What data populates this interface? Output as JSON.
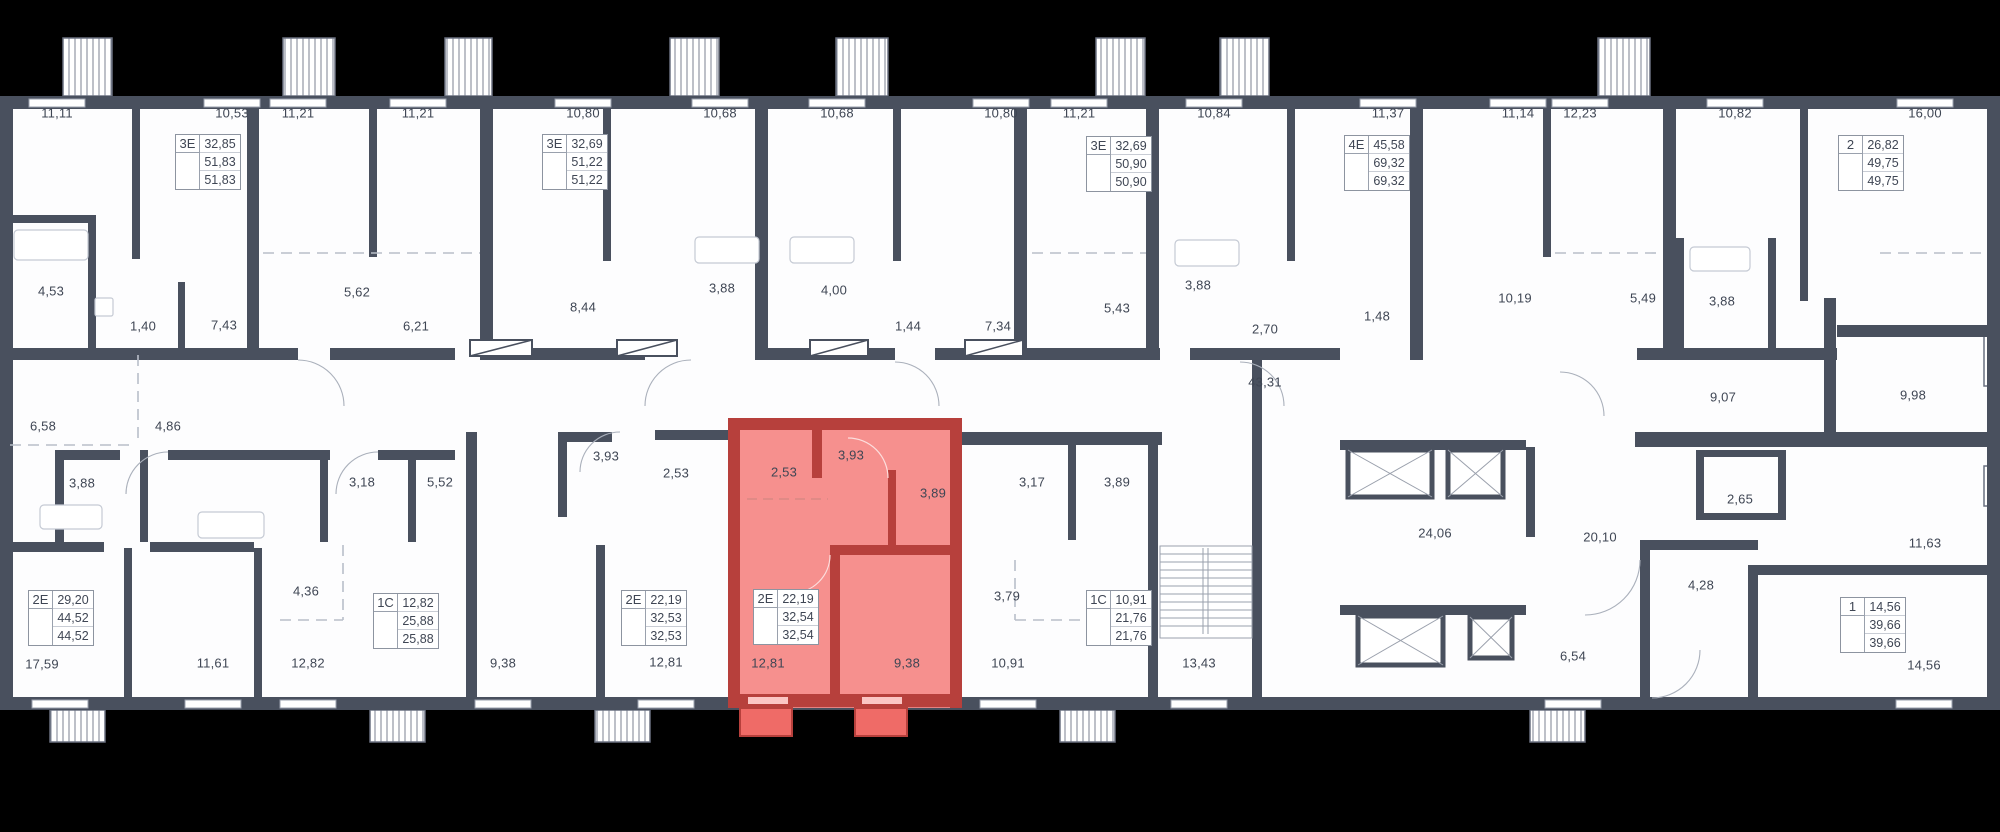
{
  "colors": {
    "wall": "#49505e",
    "background": "#000000",
    "highlight_fill": "#f58784",
    "highlight_wall": "#b7403c"
  },
  "rooms": [
    "11,11",
    "10,53",
    "11,21",
    "11,21",
    "10,80",
    "10,68",
    "10,68",
    "10,80",
    "11,21",
    "10,84",
    "11,37",
    "11,14",
    "12,23",
    "10,82",
    "16,00",
    "4,53",
    "1,40",
    "7,43",
    "5,62",
    "6,21",
    "8,44",
    "3,88",
    "4,00",
    "1,44",
    "7,34",
    "5,43",
    "3,88",
    "2,70",
    "1,48",
    "10,19",
    "5,49",
    "3,88",
    "43,31",
    "9,07",
    "9,98",
    "6,58",
    "4,86",
    "3,88",
    "3,18",
    "5,52",
    "3,93",
    "2,53",
    "2,53",
    "3,93",
    "3,89",
    "3,17",
    "3,89",
    "24,06",
    "20,10",
    "2,65",
    "11,63",
    "4,28",
    "4,36",
    "3,79",
    "17,59",
    "11,61",
    "12,82",
    "9,38",
    "12,81",
    "12,81",
    "9,38",
    "10,91",
    "13,43",
    "6,54",
    "14,56"
  ],
  "apartments": [
    {
      "type": "3Е",
      "a": "32,85",
      "b": "51,83",
      "c": "51,83"
    },
    {
      "type": "3Е",
      "a": "32,69",
      "b": "51,22",
      "c": "51,22"
    },
    {
      "type": "3Е",
      "a": "32,69",
      "b": "50,90",
      "c": "50,90"
    },
    {
      "type": "4Е",
      "a": "45,58",
      "b": "69,32",
      "c": "69,32"
    },
    {
      "type": "2",
      "a": "26,82",
      "b": "49,75",
      "c": "49,75"
    },
    {
      "type": "2Е",
      "a": "29,20",
      "b": "44,52",
      "c": "44,52"
    },
    {
      "type": "1С",
      "a": "12,82",
      "b": "25,88",
      "c": "25,88"
    },
    {
      "type": "2Е",
      "a": "22,19",
      "b": "32,53",
      "c": "32,53"
    },
    {
      "type": "2Е",
      "a": "22,19",
      "b": "32,54",
      "c": "32,54"
    },
    {
      "type": "1С",
      "a": "10,91",
      "b": "21,76",
      "c": "21,76"
    },
    {
      "type": "1",
      "a": "14,56",
      "b": "39,66",
      "c": "39,66"
    }
  ]
}
